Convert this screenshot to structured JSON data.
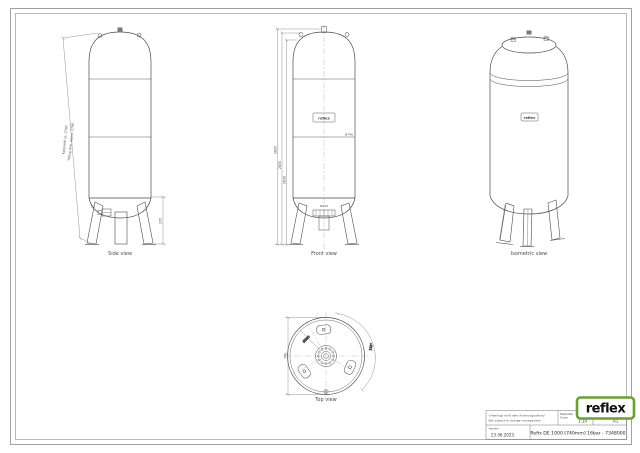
{
  "sheet": {
    "kind": "technical-drawing",
    "paper": "#ffffff"
  },
  "views": {
    "side": {
      "label": "Side view",
      "tilt_note_line1": "Kippmaß ca. 2790",
      "tilt_note_line2": "Tilting dim. apprx. 2790",
      "conn_height_dim": "235",
      "conn_label": "G1"
    },
    "front": {
      "label": "Front view",
      "dim_total": "2685",
      "dim_dome": "2655",
      "dim_body": "2630",
      "dim_diameter": "Ø740",
      "dim_bottom": "Ø270",
      "brand_label": "reflex"
    },
    "isometric": {
      "label": "Isometric view",
      "brand_label": "reflex"
    },
    "top": {
      "label": "Top view",
      "dim_diameter": "740",
      "dim_foot_circle": "Ø590",
      "dim_angle": "120°"
    }
  },
  "title_block": {
    "note_de": "Unterliegt nicht dem Änderungsdienst/",
    "note_en": "Not subject to change management",
    "scale_label_de": "Maßstab/",
    "scale_label_en": "Scale",
    "scale_value": "1:10",
    "format_label_de": "Format/",
    "format_label_en": "Size",
    "format_value": "A1",
    "version_label": "Version",
    "version_date": "23.06.2023",
    "title": "Refix DE 1000 [740mm] 16bar - 7348000"
  },
  "logo": {
    "text": "reflex",
    "color": "#67A22F"
  }
}
